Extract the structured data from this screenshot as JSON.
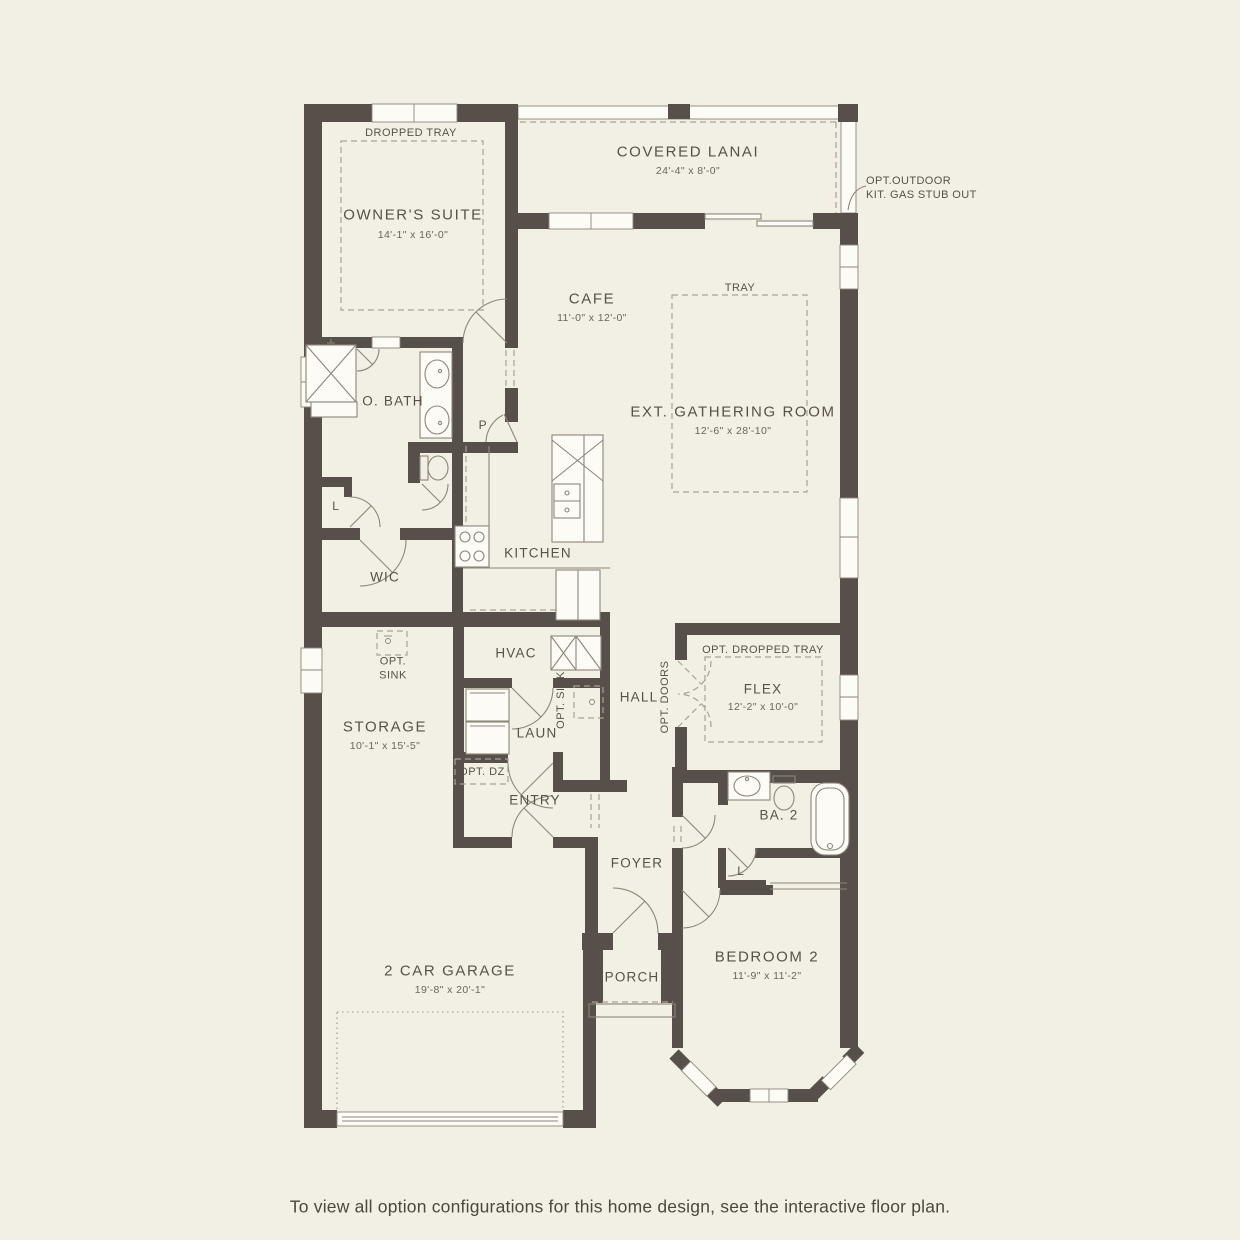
{
  "colors": {
    "background": "#f2efe4",
    "wall": "#57504a",
    "thin_line": "#8d867a",
    "dashed_line": "#a8a199",
    "text": "#57514a",
    "window_fill": "#fcfbf5"
  },
  "rooms": {
    "owners_suite": {
      "name": "OWNER'S SUITE",
      "dims": "14'-1\" x 16'-0\""
    },
    "covered_lanai": {
      "name": "COVERED LANAI",
      "dims": "24'-4\" x 8'-0\""
    },
    "cafe": {
      "name": "CAFE",
      "dims": "11'-0\" x 12'-0\""
    },
    "gathering": {
      "name": "EXT. GATHERING ROOM",
      "dims": "12'-6\" x 28'-10\""
    },
    "owners_bath": {
      "name": "O. BATH"
    },
    "wic": {
      "name": "WIC"
    },
    "kitchen": {
      "name": "KITCHEN"
    },
    "hvac": {
      "name": "HVAC"
    },
    "storage": {
      "name": "STORAGE",
      "dims": "10'-1\" x 15'-5\""
    },
    "laundry": {
      "name": "LAUN"
    },
    "hall": {
      "name": "HALL"
    },
    "flex": {
      "name": "FLEX",
      "dims": "12'-2\" x 10'-0\""
    },
    "entry": {
      "name": "ENTRY"
    },
    "bath2": {
      "name": "BA. 2"
    },
    "foyer": {
      "name": "FOYER"
    },
    "porch": {
      "name": "PORCH"
    },
    "bedroom2": {
      "name": "BEDROOM 2",
      "dims": "11'-9\" x 11'-2\""
    },
    "garage": {
      "name": "2 CAR GARAGE",
      "dims": "19'-8\" x 20'-1\""
    }
  },
  "annotations": {
    "dropped_tray": "DROPPED TRAY",
    "tray": "TRAY",
    "opt_dropped_tray": "OPT. DROPPED TRAY",
    "opt_outdoor_line1": "OPT.OUTDOOR",
    "opt_outdoor_line2": "KIT. GAS STUB OUT",
    "pantry": "P",
    "linen1": "L",
    "linen2": "L",
    "opt_sink_line1": "OPT.",
    "opt_sink_line2": "SINK",
    "opt_sink_vertical": "OPT. SINK",
    "opt_doors": "OPT. DOORS",
    "opt_dz": "OPT. DZ"
  },
  "caption": "To view all option configurations for this home design, see the interactive floor plan."
}
